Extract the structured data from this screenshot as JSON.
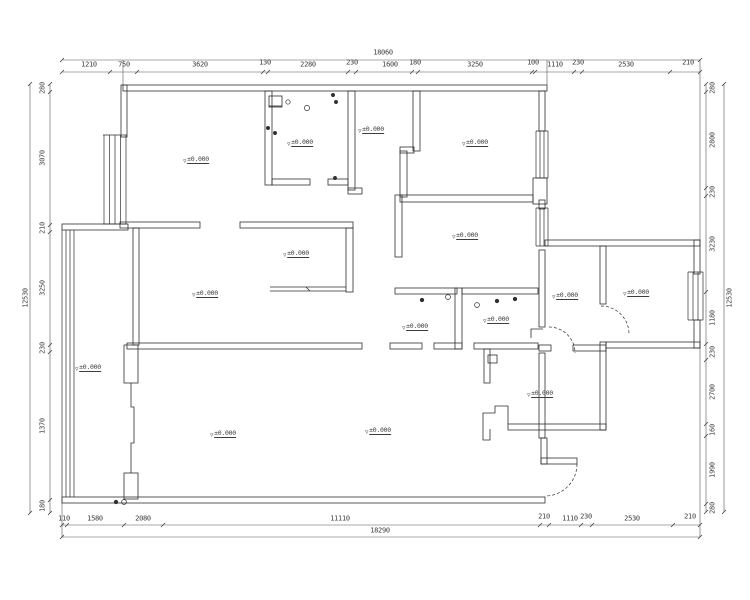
{
  "drawing": {
    "type": "residential floor plan (CAD)",
    "line_color": "#2f2f2f",
    "dim_color": "#3d3d3d",
    "elevation": {
      "text": "±0.000",
      "marker_icon": "level-triangle-icon",
      "points": [
        {
          "x": 196,
          "y": 156
        },
        {
          "x": 300,
          "y": 139
        },
        {
          "x": 371,
          "y": 126
        },
        {
          "x": 475,
          "y": 139
        },
        {
          "x": 465,
          "y": 232
        },
        {
          "x": 565,
          "y": 292
        },
        {
          "x": 636,
          "y": 289
        },
        {
          "x": 296,
          "y": 250
        },
        {
          "x": 205,
          "y": 290
        },
        {
          "x": 415,
          "y": 323
        },
        {
          "x": 496,
          "y": 316
        },
        {
          "x": 88,
          "y": 364
        },
        {
          "x": 223,
          "y": 430
        },
        {
          "x": 378,
          "y": 427
        },
        {
          "x": 540,
          "y": 390
        }
      ]
    },
    "dims": {
      "top": {
        "total": "18060",
        "total_pos": {
          "x": 383,
          "y": 53
        },
        "ticks_at": 72,
        "ticks": [
          62,
          110,
          137,
          263,
          268,
          348,
          356,
          412,
          418,
          532,
          535,
          574,
          582,
          670,
          700
        ],
        "labels": [
          {
            "x": 89,
            "y": 65,
            "t": "1210"
          },
          {
            "x": 124,
            "y": 65,
            "t": "750"
          },
          {
            "x": 200,
            "y": 65,
            "t": "3620"
          },
          {
            "x": 265,
            "y": 63,
            "t": "130"
          },
          {
            "x": 308,
            "y": 65,
            "t": "2280"
          },
          {
            "x": 352,
            "y": 63,
            "t": "230"
          },
          {
            "x": 390,
            "y": 65,
            "t": "1600"
          },
          {
            "x": 415,
            "y": 63,
            "t": "180"
          },
          {
            "x": 475,
            "y": 65,
            "t": "3250"
          },
          {
            "x": 533,
            "y": 63,
            "t": "100"
          },
          {
            "x": 555,
            "y": 65,
            "t": "1110"
          },
          {
            "x": 578,
            "y": 63,
            "t": "230"
          },
          {
            "x": 626,
            "y": 65,
            "t": "2530"
          },
          {
            "x": 688,
            "y": 63,
            "t": "210"
          }
        ]
      },
      "bottom": {
        "total": "18290",
        "total_pos": {
          "x": 380,
          "y": 531
        },
        "ticks_at": 525,
        "ticks": [
          62,
          67,
          124,
          163,
          540,
          549,
          581,
          592,
          673,
          700
        ],
        "labels": [
          {
            "x": 64,
            "y": 519,
            "t": "110"
          },
          {
            "x": 95,
            "y": 519,
            "t": "1580"
          },
          {
            "x": 143,
            "y": 519,
            "t": "2080"
          },
          {
            "x": 340,
            "y": 519,
            "t": "11110"
          },
          {
            "x": 544,
            "y": 517,
            "t": "210"
          },
          {
            "x": 570,
            "y": 519,
            "t": "1110"
          },
          {
            "x": 586,
            "y": 517,
            "t": "230"
          },
          {
            "x": 632,
            "y": 519,
            "t": "2530"
          },
          {
            "x": 690,
            "y": 517,
            "t": "210"
          }
        ]
      },
      "left": {
        "total": "12530",
        "total_pos": {
          "x": 26,
          "y": 298
        },
        "ticks_at": 50,
        "ticks": [
          84,
          92,
          225,
          232,
          345,
          352,
          500,
          513
        ],
        "labels": [
          {
            "x": 43,
            "y": 88,
            "t": "280"
          },
          {
            "x": 43,
            "y": 158,
            "t": "3070"
          },
          {
            "x": 43,
            "y": 228,
            "t": "210"
          },
          {
            "x": 43,
            "y": 288,
            "t": "3250"
          },
          {
            "x": 43,
            "y": 348,
            "t": "230"
          },
          {
            "x": 43,
            "y": 426,
            "t": "1370"
          },
          {
            "x": 43,
            "y": 506,
            "t": "180"
          }
        ]
      },
      "right": {
        "total": "12530",
        "total_pos": {
          "x": 730,
          "y": 298
        },
        "ticks_at": 706,
        "ticks": [
          84,
          92,
          188,
          196,
          292,
          344,
          360,
          424,
          436,
          504,
          512
        ],
        "labels": [
          {
            "x": 713,
            "y": 88,
            "t": "280"
          },
          {
            "x": 713,
            "y": 140,
            "t": "2800"
          },
          {
            "x": 713,
            "y": 192,
            "t": "230"
          },
          {
            "x": 713,
            "y": 244,
            "t": "3230"
          },
          {
            "x": 713,
            "y": 318,
            "t": "1180"
          },
          {
            "x": 713,
            "y": 352,
            "t": "230"
          },
          {
            "x": 713,
            "y": 392,
            "t": "2700"
          },
          {
            "x": 713,
            "y": 430,
            "t": "160"
          },
          {
            "x": 713,
            "y": 470,
            "t": "1990"
          },
          {
            "x": 713,
            "y": 508,
            "t": "280"
          }
        ]
      }
    }
  }
}
